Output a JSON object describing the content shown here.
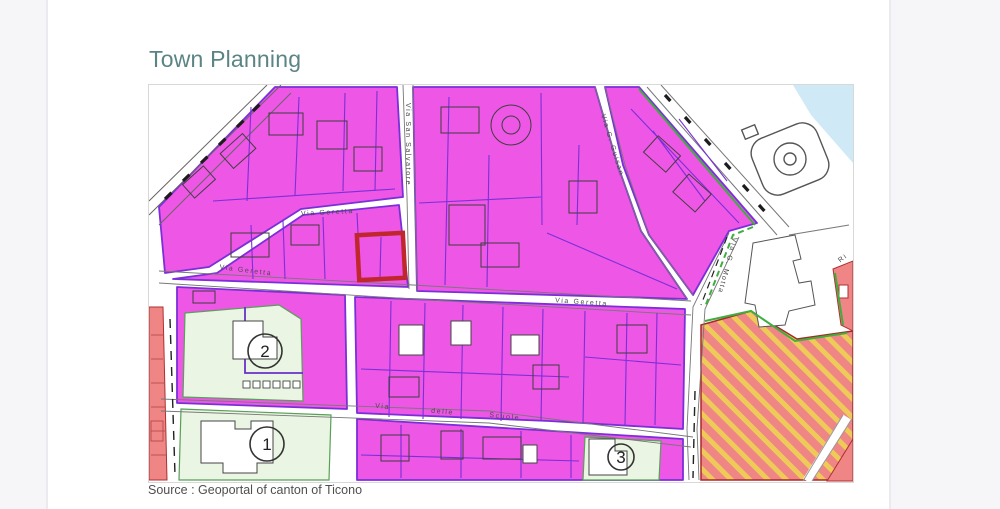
{
  "page": {
    "title": "Town Planning",
    "source_caption": "Source : Geoportal of canton of Ticono"
  },
  "map": {
    "streets": {
      "geretta_upper": "Via Geretta",
      "geretta_west": "Via Geretta",
      "geretta_east": "Via Geretta",
      "san_salvatore": "Via San Salvatore",
      "guisan": "Via G. Guisan",
      "motta": "Via G. Motta",
      "scuole_via": "Via",
      "scuole_delle": "delle",
      "scuole_scuole": "Scuole",
      "riva": "Ri"
    },
    "markers": {
      "m1": "1",
      "m2": "2",
      "m3": "3"
    },
    "highlight_parcel": {
      "color": "#c0272d"
    },
    "colors": {
      "title_text": "#5b8486",
      "zone_magenta": "#ee56e6",
      "parcel_violet": "#7b2fd8",
      "zone_light_green": "#eaf5e3",
      "zone_salmon": "#ef8585",
      "stripe_yellow": "#eecb58",
      "water_blue": "#cfe9f7",
      "boundary_green": "#3fae3f"
    }
  }
}
